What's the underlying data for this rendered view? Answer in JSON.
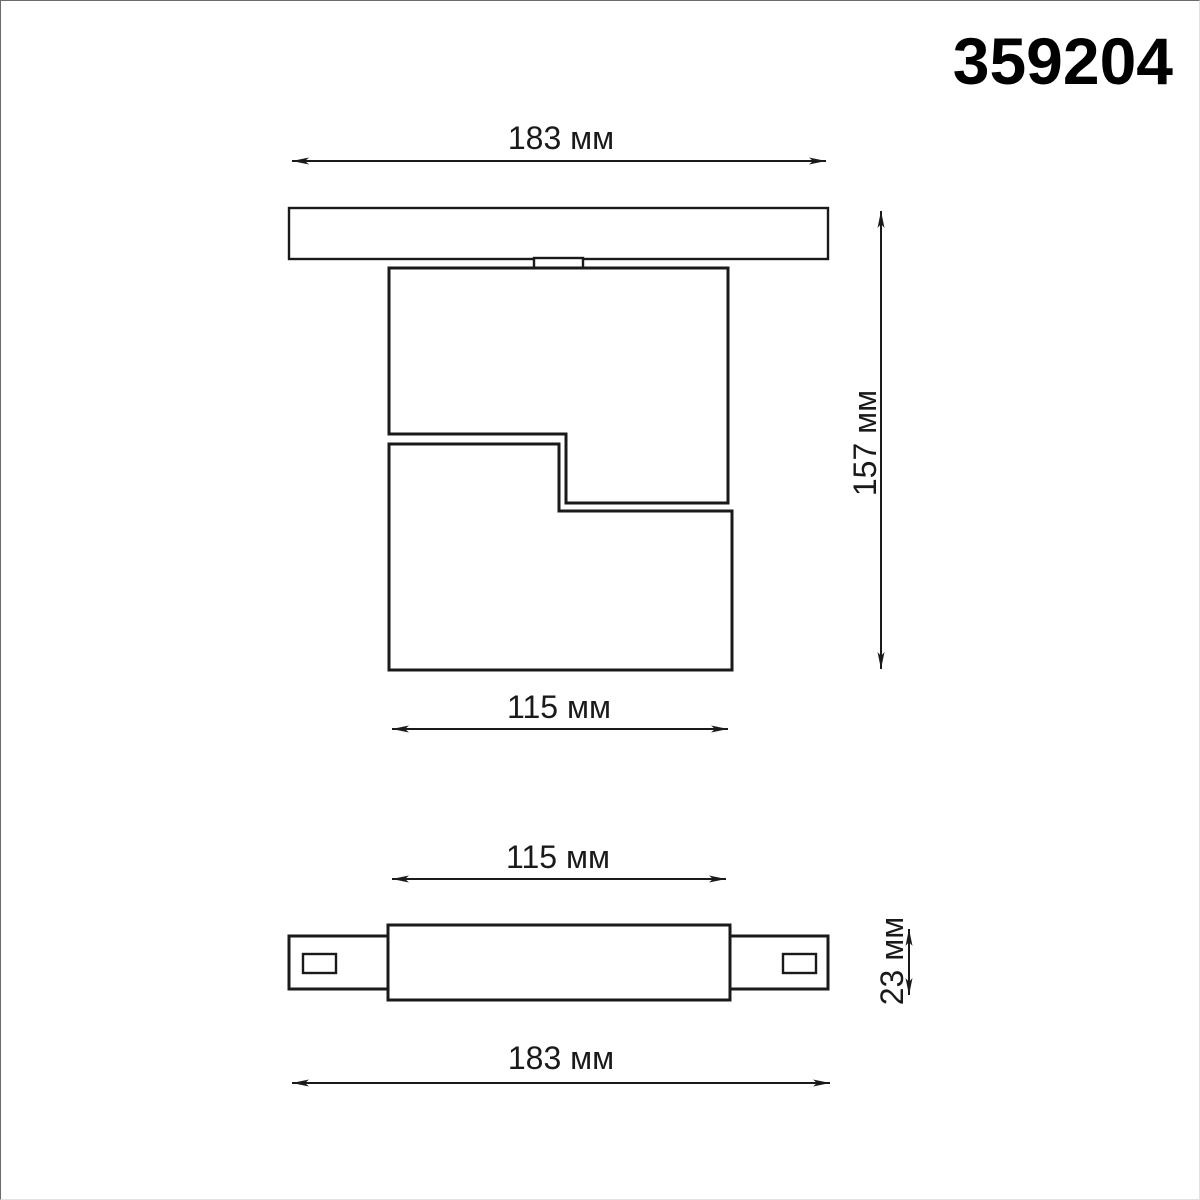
{
  "title": "359204",
  "colors": {
    "line": "#1a1a1a",
    "background": "#ffffff"
  },
  "side_view": {
    "track_width": "183 мм",
    "overall_height": "157 мм",
    "body_width": "115 мм"
  },
  "top_view": {
    "body_width": "115 мм",
    "body_height": "23 мм",
    "track_width": "183 мм"
  }
}
